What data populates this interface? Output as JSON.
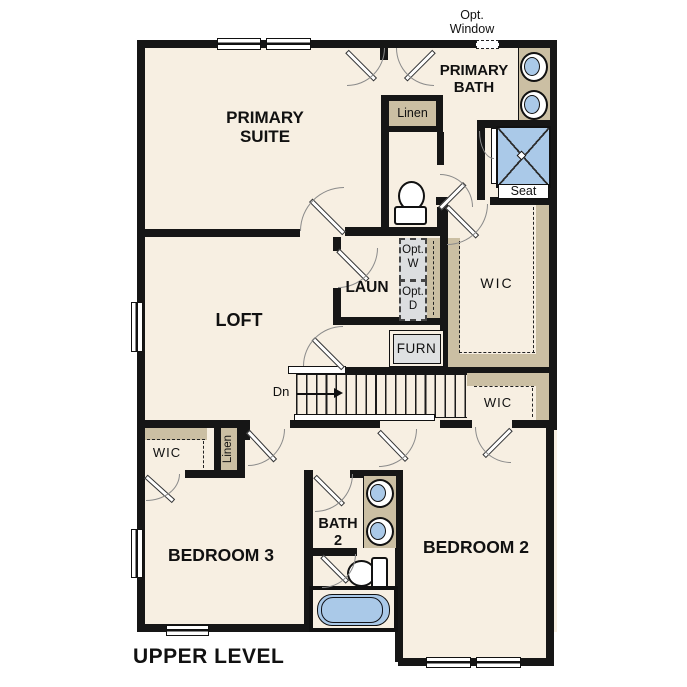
{
  "title": "UPPER LEVEL",
  "colors": {
    "wall": "#161616",
    "floor": "#f7efe2",
    "casework_tan": "#cbbfa3",
    "fixture_blue": "#aac9e8",
    "equipment_gray": "#dcdee0"
  },
  "labels": {
    "primary_suite_1": "PRIMARY",
    "primary_suite_2": "SUITE",
    "primary_bath_1": "PRIMARY",
    "primary_bath_2": "BATH",
    "opt_window_1": "Opt.",
    "opt_window_2": "Window",
    "linen_bath": "Linen",
    "loft": "LOFT",
    "laundry": "LAUN",
    "opt_washer_1": "Opt.",
    "opt_washer_2": "W",
    "opt_dryer_1": "Opt.",
    "opt_dryer_2": "D",
    "wic_primary": "WIC",
    "furnace": "FURN",
    "stairs_down": "Dn",
    "seat": "Seat",
    "wic_hall": "WIC",
    "wic_bedroom3": "WIC",
    "linen_hall": "Linen",
    "bedroom3": "BEDROOM 3",
    "bath2_1": "BATH",
    "bath2_2": "2",
    "bedroom2": "BEDROOM 2"
  }
}
